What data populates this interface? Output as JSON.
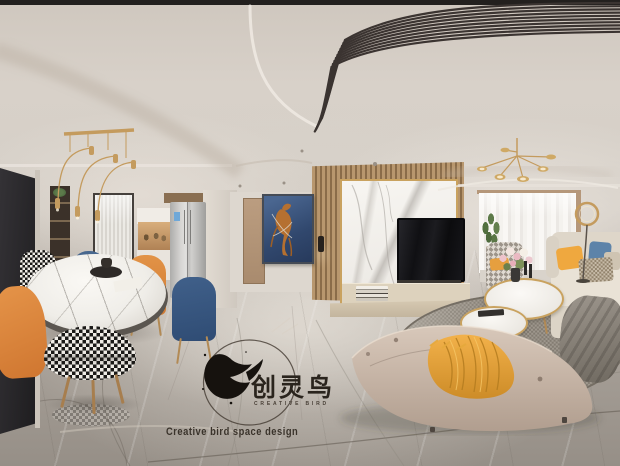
{
  "image_type": "360-degree panorama render of an apartment interior",
  "watermark": {
    "logo_cn": "创灵鸟",
    "logo_en": "CREATIVE BIRD",
    "tagline": "Creative bird space design"
  },
  "palette": {
    "ceiling": "#d8d1c9",
    "stripe_decor": "#3b3431",
    "wall": "#d5cfc7",
    "floor_marble": "#a59e96",
    "accent_gold": "#c49b5e",
    "accent_orange": "#dd8a3e",
    "accent_blue": "#3e5d85",
    "sofa_cream": "#e9e2d6",
    "bench_taupe": "#c9b8aa",
    "blanket_yellow": "#e5a53d",
    "painting_blue": "#3a5276",
    "painting_horse": "#b57030",
    "wood_slat": "#b08e64",
    "marble_white": "#f3f1ed"
  },
  "scene": {
    "areas": [
      "dining area",
      "entry hallway",
      "tv wall",
      "living room"
    ],
    "objects": [
      "entry door",
      "arc pendant lamp",
      "shelf niche",
      "reeded glass door",
      "kitchen cabinets",
      "fridge",
      "round marble dining table",
      "houndstooth stool",
      "houndstooth chair",
      "orange dining chairs",
      "blue dining chairs",
      "wooden door",
      "horse painting",
      "wood slat wall",
      "marble tv wall",
      "tv",
      "tv cabinet",
      "books",
      "sputnik chandelier",
      "sheer curtains",
      "ring floor lamp",
      "potted plant",
      "patterned armchair",
      "round coffee tables",
      "flower vase",
      "beige sofa",
      "throw pillows",
      "gray throw blanket",
      "area rug",
      "curved bench",
      "yellow blanket"
    ]
  }
}
